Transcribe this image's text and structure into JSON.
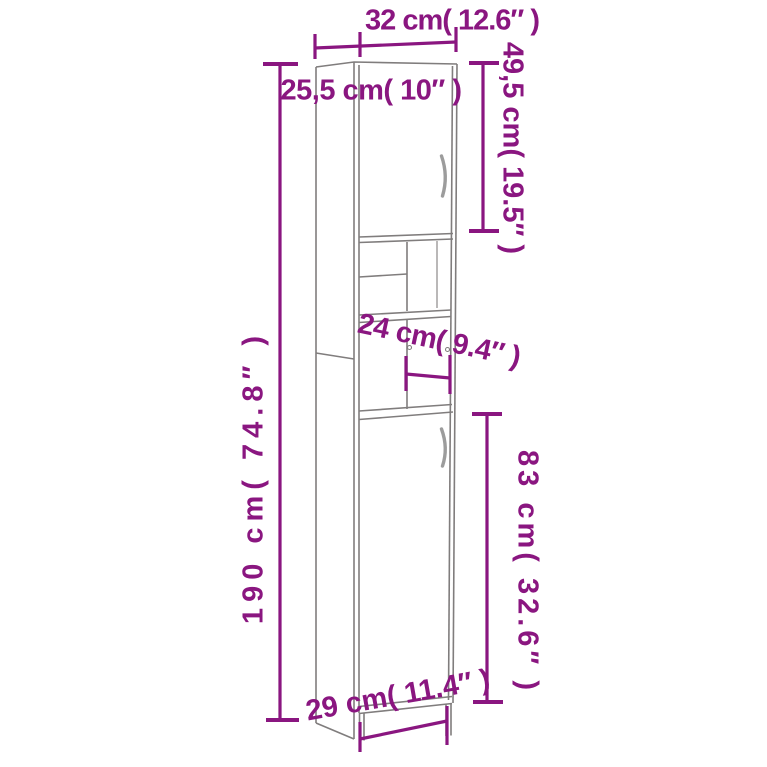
{
  "diagram": {
    "subject": "tall-cabinet-dimension-drawing",
    "labels": {
      "overall_width": "32 cm( 12.6″ )",
      "overall_depth": "25,5 cm( 10″ )",
      "top_door_height": "49,5 cm( 19.5″ )",
      "overall_height": "190 cm( 74.8″ )",
      "shelf_depth": "24 cm( 9.4″ )",
      "bottom_door_height": "83 cm( 32.6″ )",
      "base_width": "29 cm( 11.4″ )"
    }
  },
  "colors": {
    "dimension_accent": "#8a1680",
    "cabinet_outline": "#807d7d",
    "handle": "#9c9c9c",
    "background": "#ffffff"
  }
}
